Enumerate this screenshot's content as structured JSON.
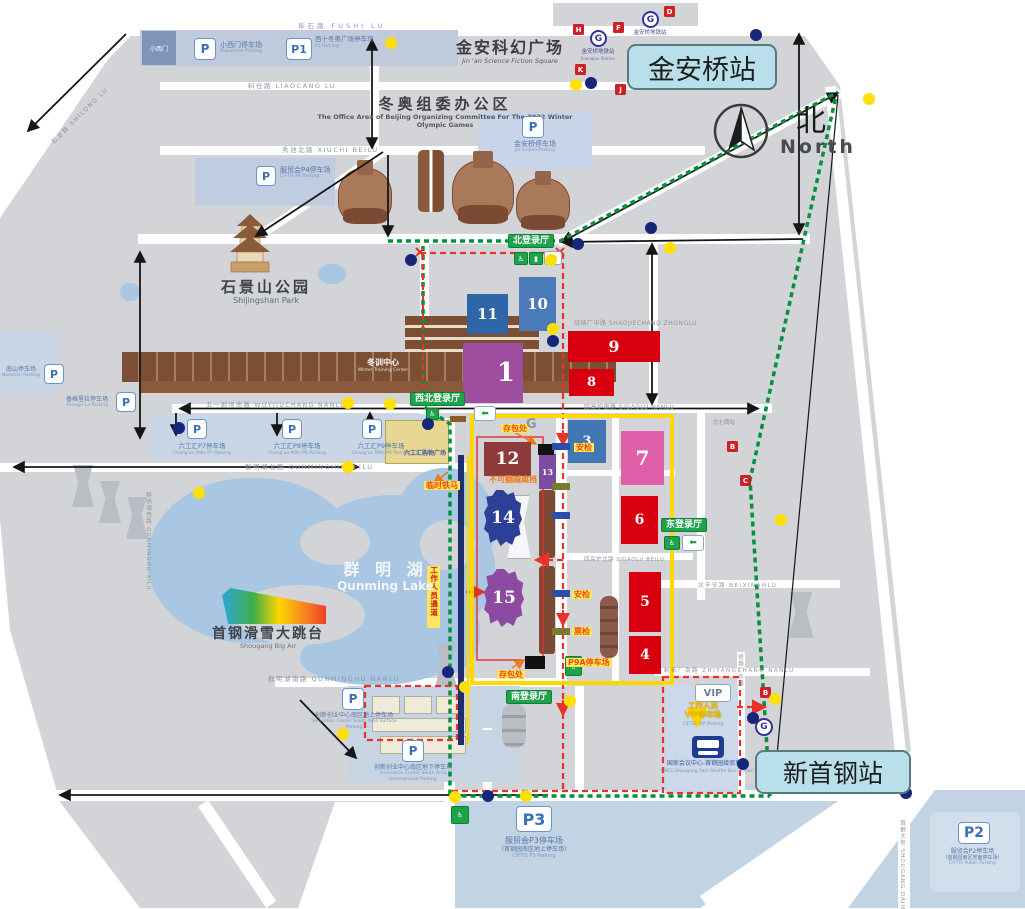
{
  "stations": {
    "jinanqiao": "金安桥站",
    "xinshougang": "新首钢站"
  },
  "compass": {
    "cn": "北",
    "en": "North"
  },
  "landmarks": {
    "scifi_cn": "金安科幻广场",
    "scifi_en": "Jin 'an Science Fiction Square",
    "office_cn": "冬奥组委办公区",
    "office_en": "The Office Area of Beijing Organizing Committee For The 2022 Winter Olympic Games",
    "park_cn": "石景山公园",
    "park_en": "Shijingshan Park",
    "lake_cn": "群 明 湖",
    "lake_en": "Qunming Lake",
    "bigair_cn": "首钢滑雪大跳台",
    "bigair_en": "Shougang Big Air",
    "training_cn": "冬训中心",
    "training_en": "Winter Training Center",
    "mall_cn": "六工汇购物广场",
    "silos_cn": "北七筒站",
    "gate_letter": "G",
    "xiaoximen_gate": "小西门"
  },
  "metro": {
    "logo": "G",
    "jinanqiao_cn": "金安桥地铁站",
    "jinanqiao_en": "Jinanqiao Station"
  },
  "streets": {
    "fushi": "阜石路 FUSHI LU",
    "shilong": "石龙路 SHILONG LU",
    "liaocang": "料仓路 LIAOCANG LU",
    "xiuchi": "秀池北路 XIUCHI BEILU",
    "shaojiechang": "烧结厂中路 SHAOJIECHANG ZHONGLU",
    "sigaolu_nan": "四高炉南路 SIGAOLU NANLU",
    "sigaolu_bei": "四高炉北路 SIGAOLU BEILU",
    "wuyijuchang": "五一剧场南路 WUYIJUCHANG NANLU",
    "qunminghu_bei": "群明湖北路 QUNMINGHU BEILU",
    "qunminghu_nan": "群明湖南路 QUNMINGHU NANLU",
    "qunminghu_xi": "群明湖西路 QUNMINGHU XILU",
    "beixinan": "北辛安路 BEIXINANLU",
    "zhiyangchang": "制氧厂南路 ZHIYANGCHANG NANLU",
    "xiulichang": "修理厂东路",
    "dajie": "首钢大街 SHOUGANG DAJIE"
  },
  "halls": {
    "north": "北登录厅",
    "northwest": "西北登录厅",
    "east": "东登录厅",
    "south": "南登录厅"
  },
  "venues": {
    "v1": "1",
    "v3": "3",
    "v4": "4",
    "v5": "5",
    "v6": "6",
    "v7": "7",
    "v8": "8",
    "v9": "9",
    "v10": "10",
    "v11": "11",
    "v12": "12",
    "v13": "13",
    "v14": "14",
    "v15": "15"
  },
  "parking": {
    "p": "P",
    "p1": "P1",
    "p2": "P2",
    "p3": "P3",
    "xiaoximen_cn": "小西门停车场",
    "xiaoximen_en": "Xiaoximen Parking",
    "xishi_cn": "西十冬奥广场停车场",
    "xishi_en": "P1 Parking",
    "jinanqiao_cn": "金安桥停车场",
    "jinanqiao_en": "Jin'anqiao Parking",
    "ciftis4_cn": "服贸会P4停车场",
    "ciftis4_en": "CIFTIS P4 Parking",
    "nanshan_cn": "南山停车场",
    "nanshan_en": "Nanshan Parking",
    "shangrila_cn": "香格里拉停车场",
    "shangrila_en": "Shangri-La Parking",
    "lgh7_cn": "六工汇P7停车场",
    "lgh7_en": "Chang'an Mills P7 Parking",
    "lgh8_cn": "六工汇P8停车场",
    "lgh8_en": "Chang'an Mills P8 Parking",
    "lgh9_cn": "六工汇P9停车场",
    "lgh9_en": "Chang'an Mills P9 Parking",
    "innov_surface_cn": "创新创业中心南区地上停车场",
    "innov_surface_en": "Innovation Center South Area Surface Parking",
    "innov_under_cn": "创新创业中心南区地下停车场",
    "innov_under_en": "Innovation Center South Area Underground Parking",
    "p3_cn": "服贸会P3停车场",
    "p3_cn2": "（首钢园南区地上停车场）",
    "p3_en": "CIFTIS P3 Parking",
    "p2_cn": "服贸会P2停车场",
    "p2_cn2": "（首钢园南区地面停车场）",
    "p2_en": "CIFTIS Public Parking",
    "vip": "VIP",
    "vip_cn1": "工作人员",
    "vip_cn2": "VIP停车场",
    "vip_en": "CIFTIS VIP Parking",
    "p9a": "P9A停车场"
  },
  "shuttle": {
    "cn": "国家会议中心-首钢园接驳车站",
    "en": "CNCC-Shougang Park Shuttle Bus Station"
  },
  "annotations": {
    "bag": "存包处",
    "barrier": "临时铁马",
    "noclimb": "不可翻越遮挡",
    "security": "安检",
    "ticket": "票检",
    "staff": "工作人员通道"
  },
  "letters": {
    "d": "D",
    "f": "F",
    "h": "H",
    "k": "K",
    "j": "J",
    "b1": "B",
    "c": "C",
    "b2": "B"
  },
  "colors": {
    "land": "#d2d4d8",
    "water": "#a9c6e3",
    "route_green": "#00913a",
    "route_red": "#e8332a",
    "boundary_yellow": "#ffd800",
    "hall_green": "#1fa24c",
    "station_bg": "#b9e0ea",
    "venue_red": "#d8000f",
    "venue_blue": "#3a6fb0",
    "venue_pink": "#df5fa8",
    "venue_purple": "#9d4e9e"
  }
}
